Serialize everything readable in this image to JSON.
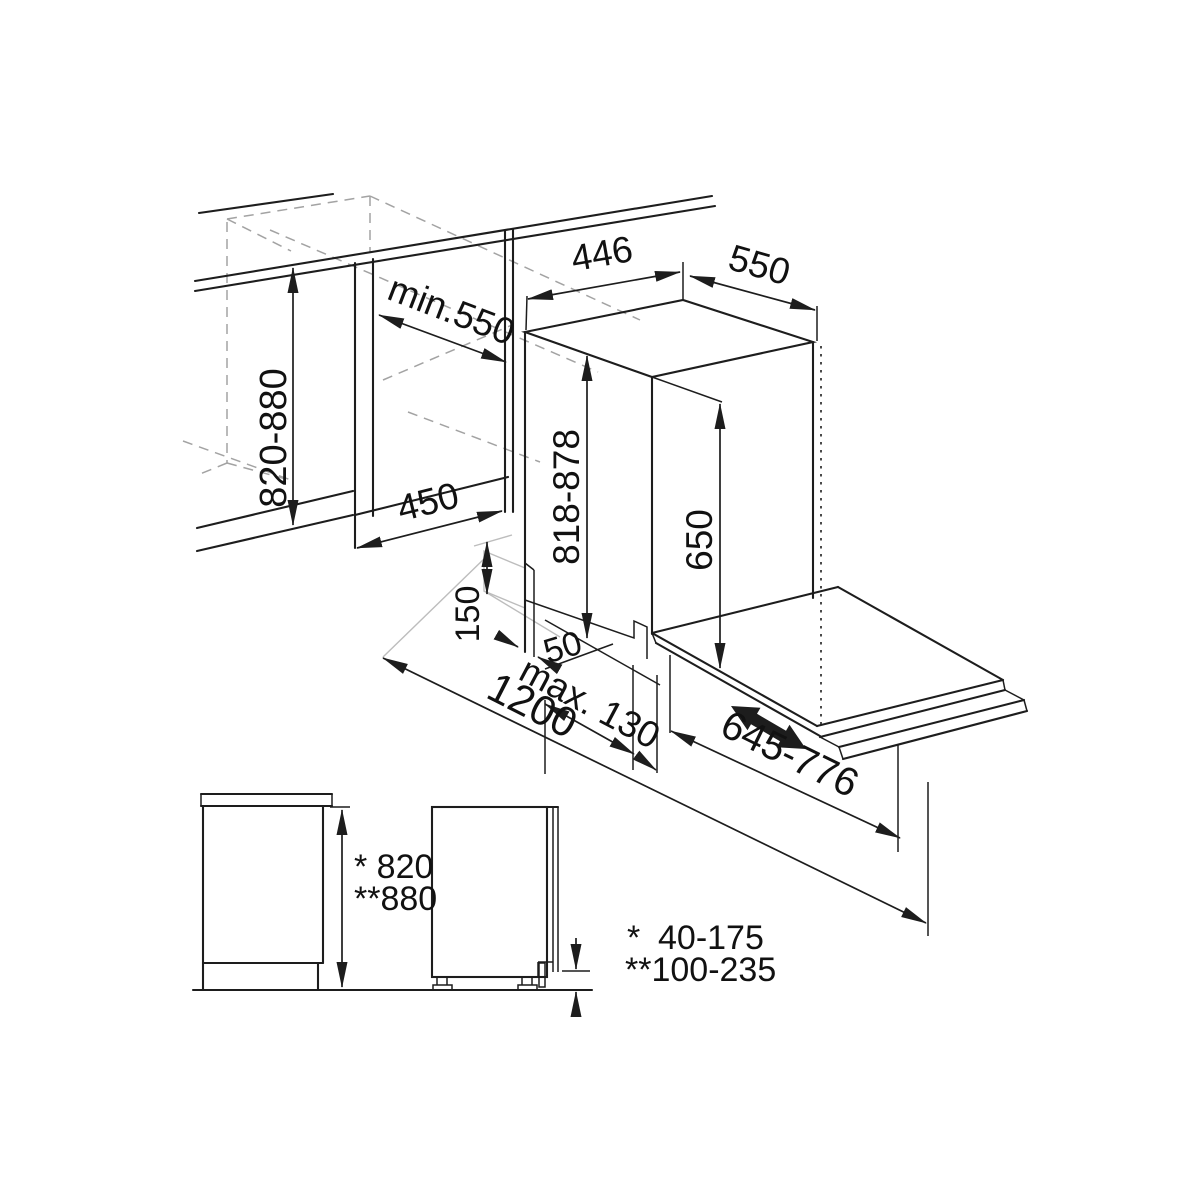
{
  "page": {
    "background": "#ffffff",
    "line_color": "#1d1d1d",
    "hidden_line_color": "#a3a3a3"
  },
  "diagram": {
    "type": "appliance-installation-drawing",
    "main_view": {
      "counter_height": "820-880",
      "niche_min_depth": "min.550",
      "niche_width": "450",
      "unit_width": "446",
      "unit_depth": "550",
      "unit_height": "818-878",
      "top_to_platform": "650",
      "plinth_height": "150",
      "front_gap": "50",
      "door_protrusion": "max. 130",
      "open_depth": "1200",
      "slide_travel": "645-776"
    },
    "side_view": {
      "height_star": "* 820",
      "height_double_star": "**880"
    },
    "legend": {
      "star": "*",
      "range_star": "40-175",
      "range_double_star": "**100-235"
    }
  }
}
